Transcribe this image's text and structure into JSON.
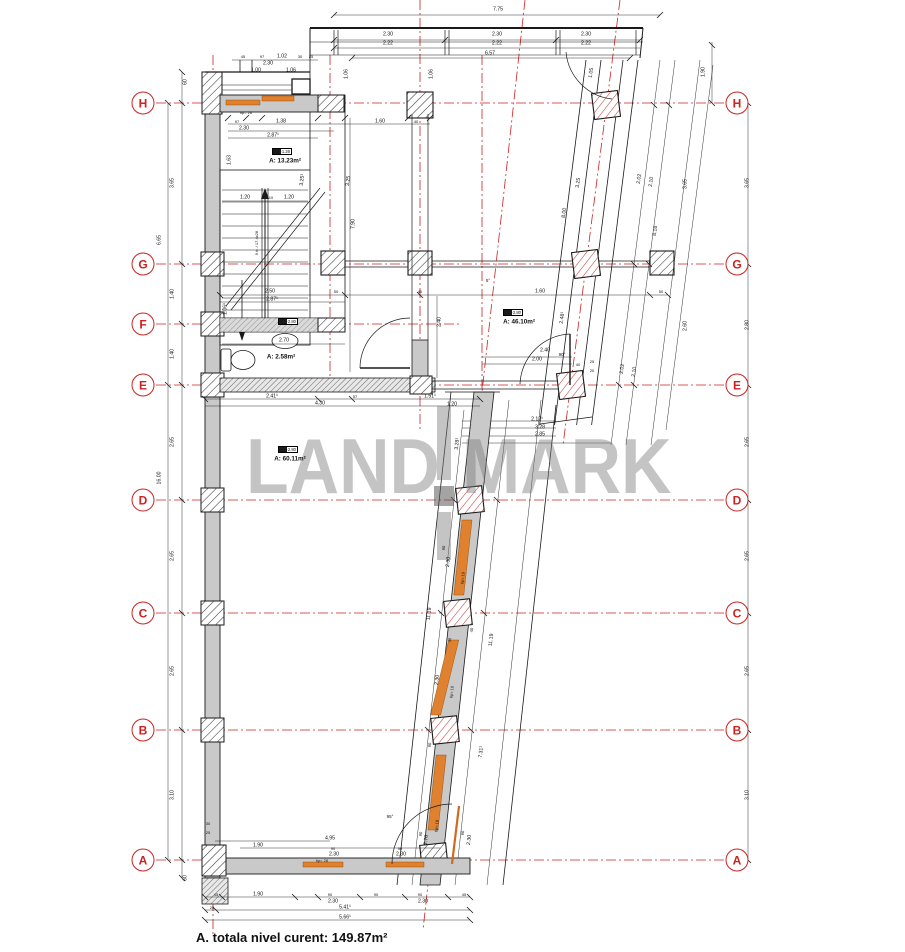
{
  "footer": {
    "total_area_note": "A. totala nivel curent: 149.87m²"
  },
  "watermark": {
    "left": "LAND",
    "right": "MARK"
  },
  "colors": {
    "grid_red": "#cc2222",
    "wall_gray": "#c9c9c9",
    "window_orange": "#e0812f",
    "watermark_gray": "#bdbdbd",
    "line_black": "#1a1a1a"
  },
  "grid": {
    "x_left": 143,
    "x_right": 737,
    "left": [
      {
        "label": "H",
        "y": 103
      },
      {
        "label": "G",
        "y": 264
      },
      {
        "label": "F",
        "y": 324
      },
      {
        "label": "E",
        "y": 385
      },
      {
        "label": "D",
        "y": 500
      },
      {
        "label": "C",
        "y": 613
      },
      {
        "label": "B",
        "y": 730
      },
      {
        "label": "A",
        "y": 860
      }
    ],
    "right": [
      {
        "label": "H",
        "y": 103
      },
      {
        "label": "G",
        "y": 264
      },
      {
        "label": "E",
        "y": 385
      },
      {
        "label": "D",
        "y": 500
      },
      {
        "label": "C",
        "y": 613
      },
      {
        "label": "B",
        "y": 730
      },
      {
        "label": "A",
        "y": 860
      }
    ]
  },
  "rooms": [
    {
      "tag": "+1.26",
      "area": "A: 13.23m²",
      "tx": 272,
      "ty": 148,
      "x": 285,
      "y": 161
    },
    {
      "tag": "+2.80",
      "area": "A: 46.10m²",
      "tx": 503,
      "ty": 309,
      "x": 519,
      "y": 322
    },
    {
      "tag": "+2.80",
      "area": "A: 2.58m²",
      "tx": 278,
      "ty": 318,
      "x": 281,
      "y": 357
    },
    {
      "tag": "+2.80",
      "area": "A: 60.11m²",
      "tx": 278,
      "ty": 446,
      "x": 290,
      "y": 459
    }
  ],
  "dims": [
    {
      "t": "7.75",
      "x": 498,
      "y": 10
    },
    {
      "t": "2.30",
      "x": 388,
      "y": 35
    },
    {
      "t": "2.22",
      "x": 388,
      "y": 44
    },
    {
      "t": "2.30",
      "x": 497,
      "y": 35
    },
    {
      "t": "2.22",
      "x": 497,
      "y": 44
    },
    {
      "t": "2.30",
      "x": 586,
      "y": 35
    },
    {
      "t": "2.22",
      "x": 586,
      "y": 44
    },
    {
      "t": "6.57",
      "x": 490,
      "y": 54
    },
    {
      "t": "45",
      "x": 243,
      "y": 57,
      "s": 4
    },
    {
      "t": "97",
      "x": 262,
      "y": 57,
      "s": 4
    },
    {
      "t": "1.02",
      "x": 282,
      "y": 57
    },
    {
      "t": "30",
      "x": 300,
      "y": 57,
      "s": 4
    },
    {
      "t": "25",
      "x": 311,
      "y": 57,
      "s": 4
    },
    {
      "t": "2.30",
      "x": 268,
      "y": 64
    },
    {
      "t": "1.00",
      "x": 256,
      "y": 71
    },
    {
      "t": "1.06",
      "x": 291,
      "y": 71
    },
    {
      "t": "1.06",
      "x": 347,
      "y": 74,
      "r": -90
    },
    {
      "t": "1.06",
      "x": 432,
      "y": 74,
      "r": -90
    },
    {
      "t": "1.90",
      "x": 704,
      "y": 72,
      "r": -90
    },
    {
      "t": "60",
      "x": 186,
      "y": 82,
      "r": -90
    },
    {
      "t": "tip= 26",
      "x": 246,
      "y": 113,
      "s": 4
    },
    {
      "t": "97",
      "x": 237,
      "y": 122,
      "s": 4
    },
    {
      "t": "1.38",
      "x": 281,
      "y": 122
    },
    {
      "t": "1.60",
      "x": 380,
      "y": 122
    },
    {
      "t": "40",
      "x": 416,
      "y": 122,
      "s": 4
    },
    {
      "t": "2.30",
      "x": 244,
      "y": 129
    },
    {
      "t": "2.87¹",
      "x": 273,
      "y": 136
    },
    {
      "t": "1.63",
      "x": 230,
      "y": 160,
      "r": -90
    },
    {
      "t": "3.65",
      "x": 173,
      "y": 183,
      "r": -90
    },
    {
      "t": "6.65",
      "x": 160,
      "y": 240,
      "r": -90
    },
    {
      "t": "3.25¹",
      "x": 303,
      "y": 180,
      "r": -84
    },
    {
      "t": "3.25",
      "x": 349,
      "y": 181,
      "r": -84
    },
    {
      "t": "7.90",
      "x": 354,
      "y": 224,
      "r": -90
    },
    {
      "t": "9 tr. / 17.4x28",
      "x": 257,
      "y": 243,
      "r": -90,
      "s": 4
    },
    {
      "t": "1.20",
      "x": 245,
      "y": 198
    },
    {
      "t": "10",
      "x": 271,
      "y": 198,
      "s": 4
    },
    {
      "t": "1.20",
      "x": 289,
      "y": 198
    },
    {
      "t": "1.40",
      "x": 173,
      "y": 294,
      "r": -90
    },
    {
      "t": "1.40",
      "x": 173,
      "y": 354,
      "r": -90
    },
    {
      "t": "2.50",
      "x": 270,
      "y": 292
    },
    {
      "t": "2.87¹",
      "x": 272,
      "y": 300
    },
    {
      "t": "50",
      "x": 336,
      "y": 292,
      "s": 4
    },
    {
      "t": "40",
      "x": 420,
      "y": 292,
      "s": 4
    },
    {
      "t": "1.60",
      "x": 540,
      "y": 292
    },
    {
      "t": "50",
      "x": 661,
      "y": 292,
      "s": 4
    },
    {
      "t": "1.06¹",
      "x": 226,
      "y": 309,
      "r": -90
    },
    {
      "t": "2.70",
      "x": 284,
      "y": 341
    },
    {
      "t": "2.40",
      "x": 440,
      "y": 322,
      "r": -90
    },
    {
      "t": "2.41¹",
      "x": 272,
      "y": 397
    },
    {
      "t": "57",
      "x": 355,
      "y": 397,
      "s": 4
    },
    {
      "t": "1.51¹",
      "x": 430,
      "y": 397
    },
    {
      "t": "4.30",
      "x": 320,
      "y": 404
    },
    {
      "t": "2.40",
      "x": 545,
      "y": 351
    },
    {
      "t": "2.00",
      "x": 537,
      "y": 360
    },
    {
      "t": "90°",
      "x": 562,
      "y": 355,
      "s": 4.5
    },
    {
      "t": "40",
      "x": 578,
      "y": 365,
      "s": 4
    },
    {
      "t": "25",
      "x": 592,
      "y": 362,
      "s": 4
    },
    {
      "t": "20",
      "x": 592,
      "y": 371,
      "s": 4
    },
    {
      "t": "5°",
      "x": 488,
      "y": 281,
      "s": 4.5
    },
    {
      "t": "1.05",
      "x": 592,
      "y": 73,
      "r": -82
    },
    {
      "t": "2.48¹",
      "x": 563,
      "y": 318,
      "r": -82
    },
    {
      "t": "3.25",
      "x": 579,
      "y": 183,
      "r": -82
    },
    {
      "t": "8.00",
      "x": 565,
      "y": 213,
      "r": -82
    },
    {
      "t": "2.02",
      "x": 640,
      "y": 179,
      "r": -82
    },
    {
      "t": "2.10",
      "x": 652,
      "y": 182,
      "r": -82
    },
    {
      "t": "8.18",
      "x": 656,
      "y": 231,
      "r": -82
    },
    {
      "t": "3.65",
      "x": 686,
      "y": 184,
      "r": -90
    },
    {
      "t": "2.60",
      "x": 686,
      "y": 326,
      "r": -90
    },
    {
      "t": "2.02",
      "x": 623,
      "y": 369,
      "r": -82
    },
    {
      "t": "2.10",
      "x": 635,
      "y": 372,
      "r": -82
    },
    {
      "t": "2.12¹",
      "x": 537,
      "y": 420
    },
    {
      "t": "3.28",
      "x": 540,
      "y": 428
    },
    {
      "t": "2.85",
      "x": 540,
      "y": 435
    },
    {
      "t": "3.65",
      "x": 748,
      "y": 183,
      "r": -90
    },
    {
      "t": "2.80",
      "x": 748,
      "y": 325,
      "r": -90
    },
    {
      "t": "2.65",
      "x": 173,
      "y": 442,
      "r": -90
    },
    {
      "t": "16.00",
      "x": 160,
      "y": 478,
      "r": -90
    },
    {
      "t": "2.65",
      "x": 748,
      "y": 442,
      "r": -90
    },
    {
      "t": "1.20",
      "x": 452,
      "y": 405
    },
    {
      "t": "3.28¹",
      "x": 458,
      "y": 444,
      "r": -84
    },
    {
      "t": "11.19",
      "x": 430,
      "y": 614,
      "r": -84
    },
    {
      "t": "11.19",
      "x": 492,
      "y": 640,
      "r": -84
    },
    {
      "t": "90",
      "x": 444,
      "y": 548,
      "r": -84,
      "s": 4
    },
    {
      "t": "2.30",
      "x": 449,
      "y": 562,
      "r": -84
    },
    {
      "t": "tip= 19",
      "x": 463,
      "y": 578,
      "r": -84,
      "s": 4
    },
    {
      "t": "45",
      "x": 450,
      "y": 640,
      "r": -84,
      "s": 4
    },
    {
      "t": "40",
      "x": 472,
      "y": 630,
      "r": -84,
      "s": 4
    },
    {
      "t": "2.30",
      "x": 438,
      "y": 680,
      "r": -84
    },
    {
      "t": "tip= 19",
      "x": 452,
      "y": 692,
      "r": -84,
      "s": 4
    },
    {
      "t": "90",
      "x": 430,
      "y": 745,
      "r": -84,
      "s": 4
    },
    {
      "t": "7.31¹",
      "x": 482,
      "y": 752,
      "r": -84
    },
    {
      "t": "2.65",
      "x": 173,
      "y": 556,
      "r": -90
    },
    {
      "t": "2.65",
      "x": 173,
      "y": 671,
      "r": -90
    },
    {
      "t": "3.10",
      "x": 173,
      "y": 795,
      "r": -90
    },
    {
      "t": "2.65",
      "x": 748,
      "y": 556,
      "r": -90
    },
    {
      "t": "2.65",
      "x": 748,
      "y": 671,
      "r": -90
    },
    {
      "t": "3.10",
      "x": 748,
      "y": 795,
      "r": -90
    },
    {
      "t": "60",
      "x": 186,
      "y": 878,
      "r": -90
    },
    {
      "t": "95°",
      "x": 390,
      "y": 817,
      "s": 4.5
    },
    {
      "t": "4.95",
      "x": 330,
      "y": 839
    },
    {
      "t": "1.90",
      "x": 258,
      "y": 846
    },
    {
      "t": "90",
      "x": 333,
      "y": 849,
      "s": 4
    },
    {
      "t": "2.30",
      "x": 334,
      "y": 855
    },
    {
      "t": "tip= 28",
      "x": 322,
      "y": 861,
      "s": 4
    },
    {
      "t": "90",
      "x": 400,
      "y": 849,
      "s": 4
    },
    {
      "t": "2.30",
      "x": 401,
      "y": 855
    },
    {
      "t": "tip= 18",
      "x": 437,
      "y": 826,
      "r": -84,
      "s": 4
    },
    {
      "t": "90",
      "x": 421,
      "y": 834,
      "r": -84,
      "s": 4
    },
    {
      "t": "2.70",
      "x": 427,
      "y": 840,
      "r": -84
    },
    {
      "t": "90",
      "x": 463,
      "y": 833,
      "r": -84,
      "s": 4
    },
    {
      "t": "2.30",
      "x": 470,
      "y": 840,
      "r": -84
    },
    {
      "t": "30",
      "x": 208,
      "y": 824,
      "s": 4
    },
    {
      "t": "25",
      "x": 208,
      "y": 833,
      "s": 4
    },
    {
      "t": "45",
      "x": 216,
      "y": 895,
      "s": 4
    },
    {
      "t": "1.90",
      "x": 258,
      "y": 895
    },
    {
      "t": "90",
      "x": 330,
      "y": 895,
      "s": 4
    },
    {
      "t": "2.30",
      "x": 333,
      "y": 902
    },
    {
      "t": "90",
      "x": 376,
      "y": 895,
      "s": 4
    },
    {
      "t": "90",
      "x": 420,
      "y": 895,
      "s": 4
    },
    {
      "t": "2.30",
      "x": 423,
      "y": 902
    },
    {
      "t": "45",
      "x": 464,
      "y": 895,
      "s": 4
    },
    {
      "t": "25",
      "x": 212,
      "y": 908,
      "s": 4
    },
    {
      "t": "5.41¹",
      "x": 345,
      "y": 908
    },
    {
      "t": "5.66¹",
      "x": 345,
      "y": 918
    }
  ]
}
